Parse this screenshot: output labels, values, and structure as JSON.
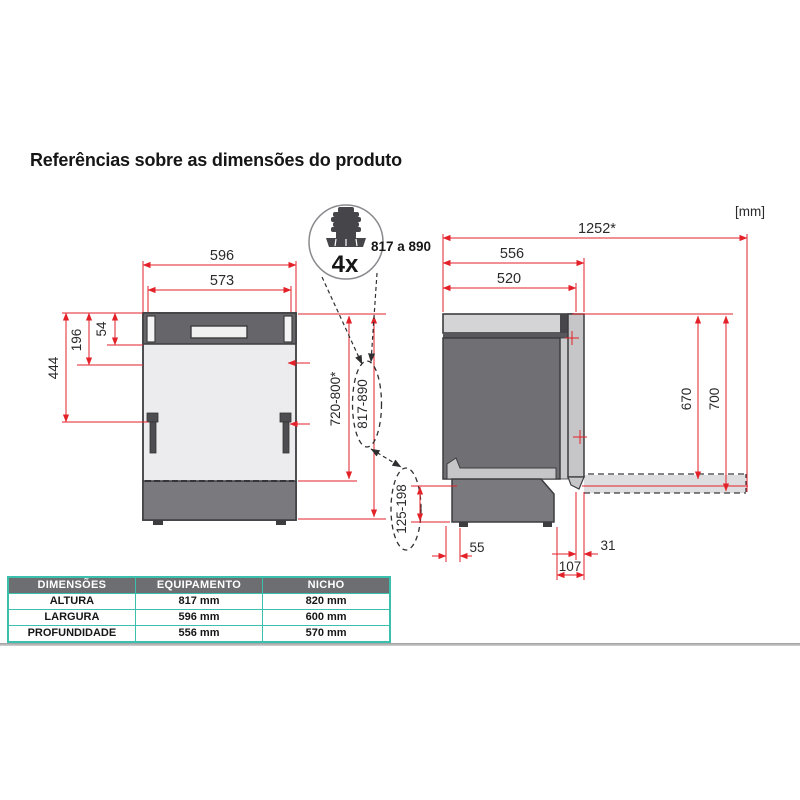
{
  "title": "Referências sobre as dimensões do produto",
  "unit_label": "[mm]",
  "colors": {
    "accent_red": "#e32129",
    "table_border_teal": "#3cc0ae",
    "table_header_bg": "#6d6e71"
  },
  "foot_detail": {
    "quantity": "4x",
    "height_range": "817 a 890"
  },
  "front_view": {
    "width_outer": "596",
    "width_inner": "573",
    "panel_height": "54",
    "upper_section": "196",
    "hinge_height": "444",
    "height_no_feet": "720-800*",
    "height_with_feet": "817-890"
  },
  "side_view": {
    "depth_door_open": "1252*",
    "depth_total": "556",
    "depth_body": "520",
    "door_top_height": "670",
    "door_floor_height": "700",
    "plinth_range": "125-198",
    "rear_foot_offset": "55",
    "door_overhang": "31",
    "front_offset": "107"
  },
  "table": {
    "headers": [
      "DIMENSÕES",
      "EQUIPAMENTO",
      "NICHO"
    ],
    "rows": [
      {
        "label": "ALTURA",
        "equipment": "817 mm",
        "niche": "820 mm"
      },
      {
        "label": "LARGURA",
        "equipment": "596 mm",
        "niche": "600 mm"
      },
      {
        "label": "PROFUNDIDADE",
        "equipment": "556 mm",
        "niche": "570 mm"
      }
    ]
  }
}
